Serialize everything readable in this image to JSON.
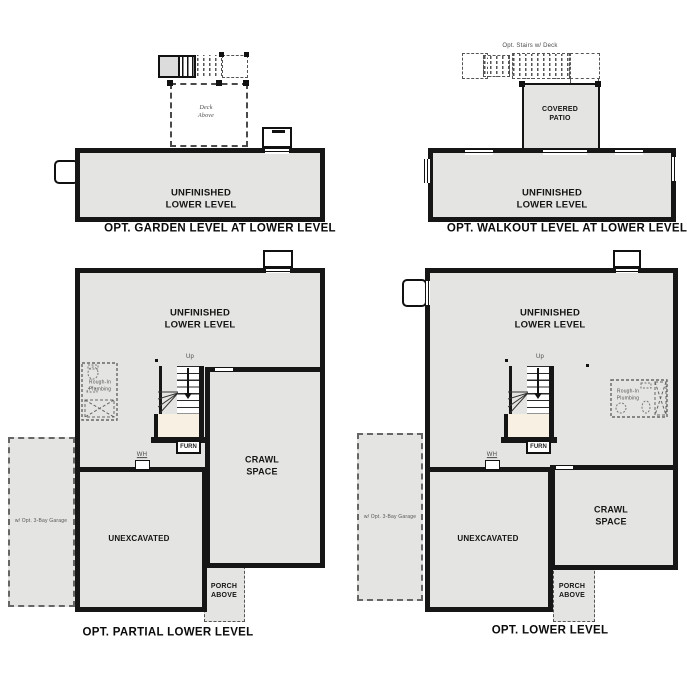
{
  "colors": {
    "floor": "#e4e4e2",
    "wall": "#161616",
    "stair_landing": "#f8f0e3",
    "dash": "#4a4a4a"
  },
  "shared": {
    "unfinished_label": "UNFINISHED\nLOWER LEVEL",
    "crawl_label": "CRAWL\nSPACE",
    "unexcavated_label": "UNEXCAVATED",
    "porch_label": "PORCH\nABOVE",
    "garage_label": "w/ Opt. 3-Bay Garage",
    "plumbing_label": "Rough-In\nPlumbing",
    "up_label": "Up",
    "furnace_label": "FURN",
    "water_heater_label": "WH"
  },
  "plans": {
    "garden": {
      "caption": "OPT. GARDEN LEVEL AT LOWER LEVEL",
      "deck_label": "Deck\nAbove"
    },
    "walkout": {
      "caption": "OPT. WALKOUT LEVEL AT LOWER LEVEL",
      "patio_label": "COVERED\nPATIO",
      "stairs_label": "Opt. Stairs w/ Deck"
    },
    "partial": {
      "caption": "OPT. PARTIAL LOWER LEVEL"
    },
    "lower": {
      "caption": "OPT. LOWER LEVEL"
    }
  }
}
